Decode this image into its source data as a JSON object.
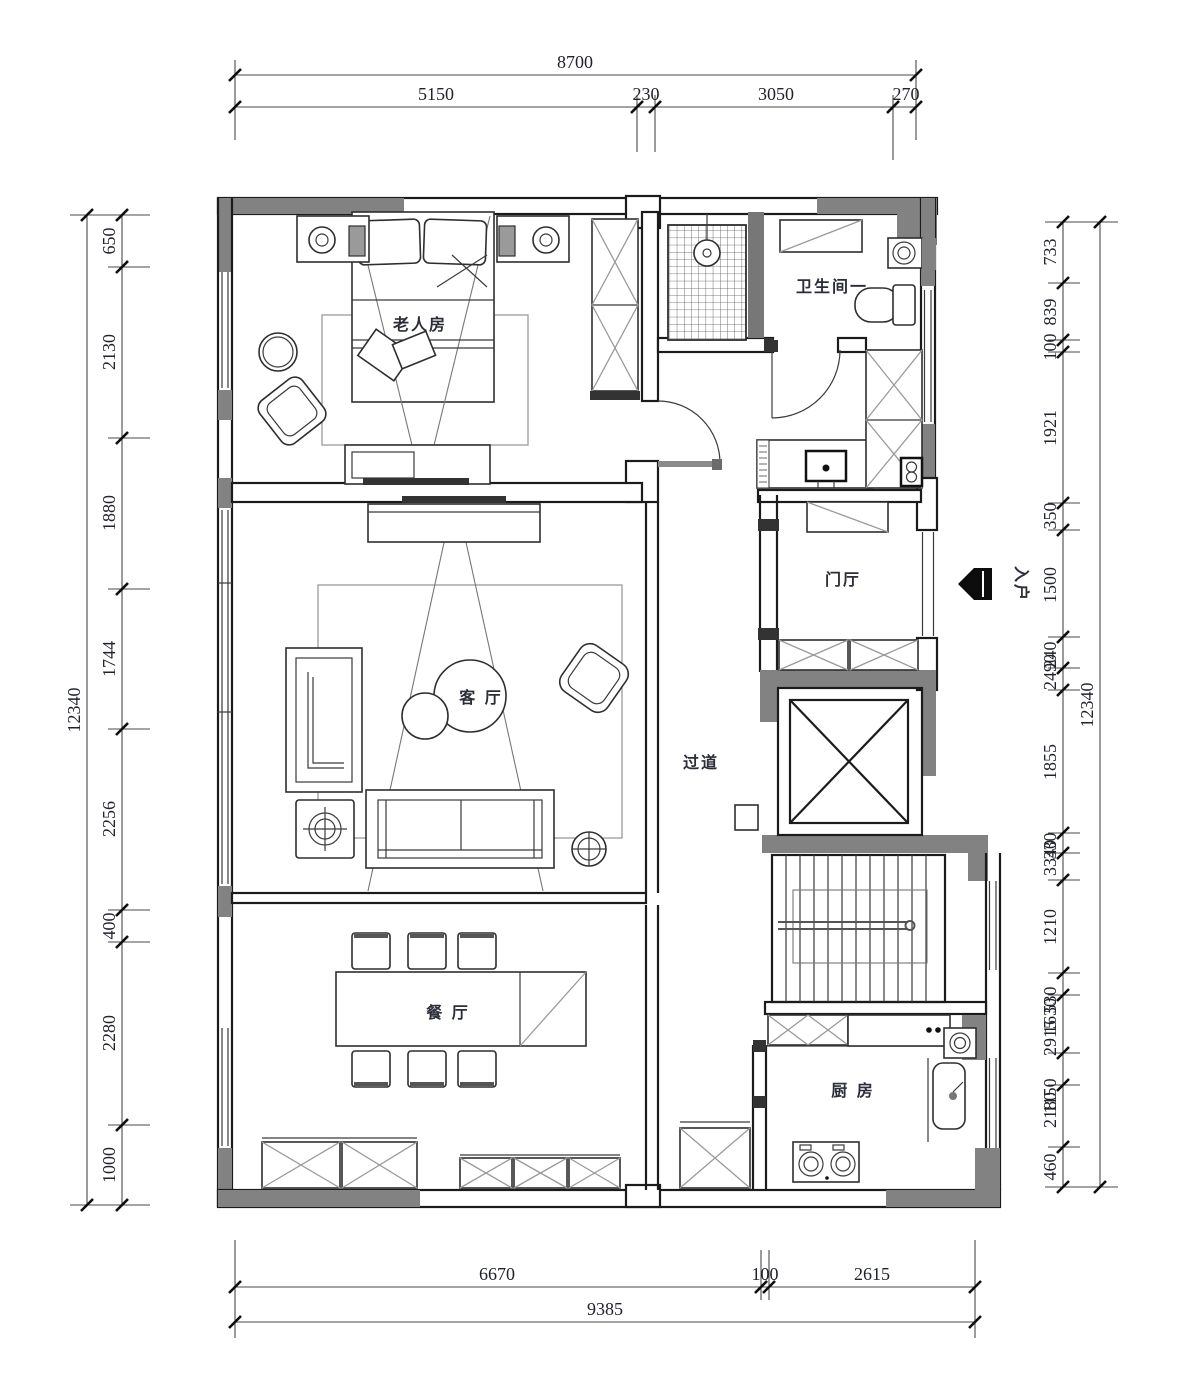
{
  "drawing": {
    "rooms": {
      "bedroom": "老人房",
      "bathroom": "卫生间一",
      "foyer": "门厅",
      "living": "客 厅",
      "corridor": "过道",
      "dining": "餐 厅",
      "kitchen": "厨 房"
    },
    "entry_label": "入户",
    "colors": {
      "wall_gray": "#828282",
      "line": "#1b1b1b",
      "dim_text": "#20232b"
    }
  },
  "dims": {
    "top": {
      "total": "8700",
      "segs": [
        "5150",
        "230",
        "3050",
        "270"
      ]
    },
    "left": {
      "total": "12340",
      "segs": [
        "650",
        "2130",
        "1880",
        "1744",
        "2256",
        "400",
        "2280",
        "1000"
      ]
    },
    "right": {
      "total": "12340",
      "segs": [
        "733",
        "839",
        "100",
        "1921",
        "350",
        "1500",
        "240",
        "2490",
        "1855",
        "330",
        "3340",
        "1210",
        "530",
        "1630",
        "2915",
        "1150",
        "2180",
        "460"
      ]
    },
    "bottom": {
      "total": "9385",
      "segs": [
        "6670",
        "100",
        "2615"
      ]
    }
  }
}
